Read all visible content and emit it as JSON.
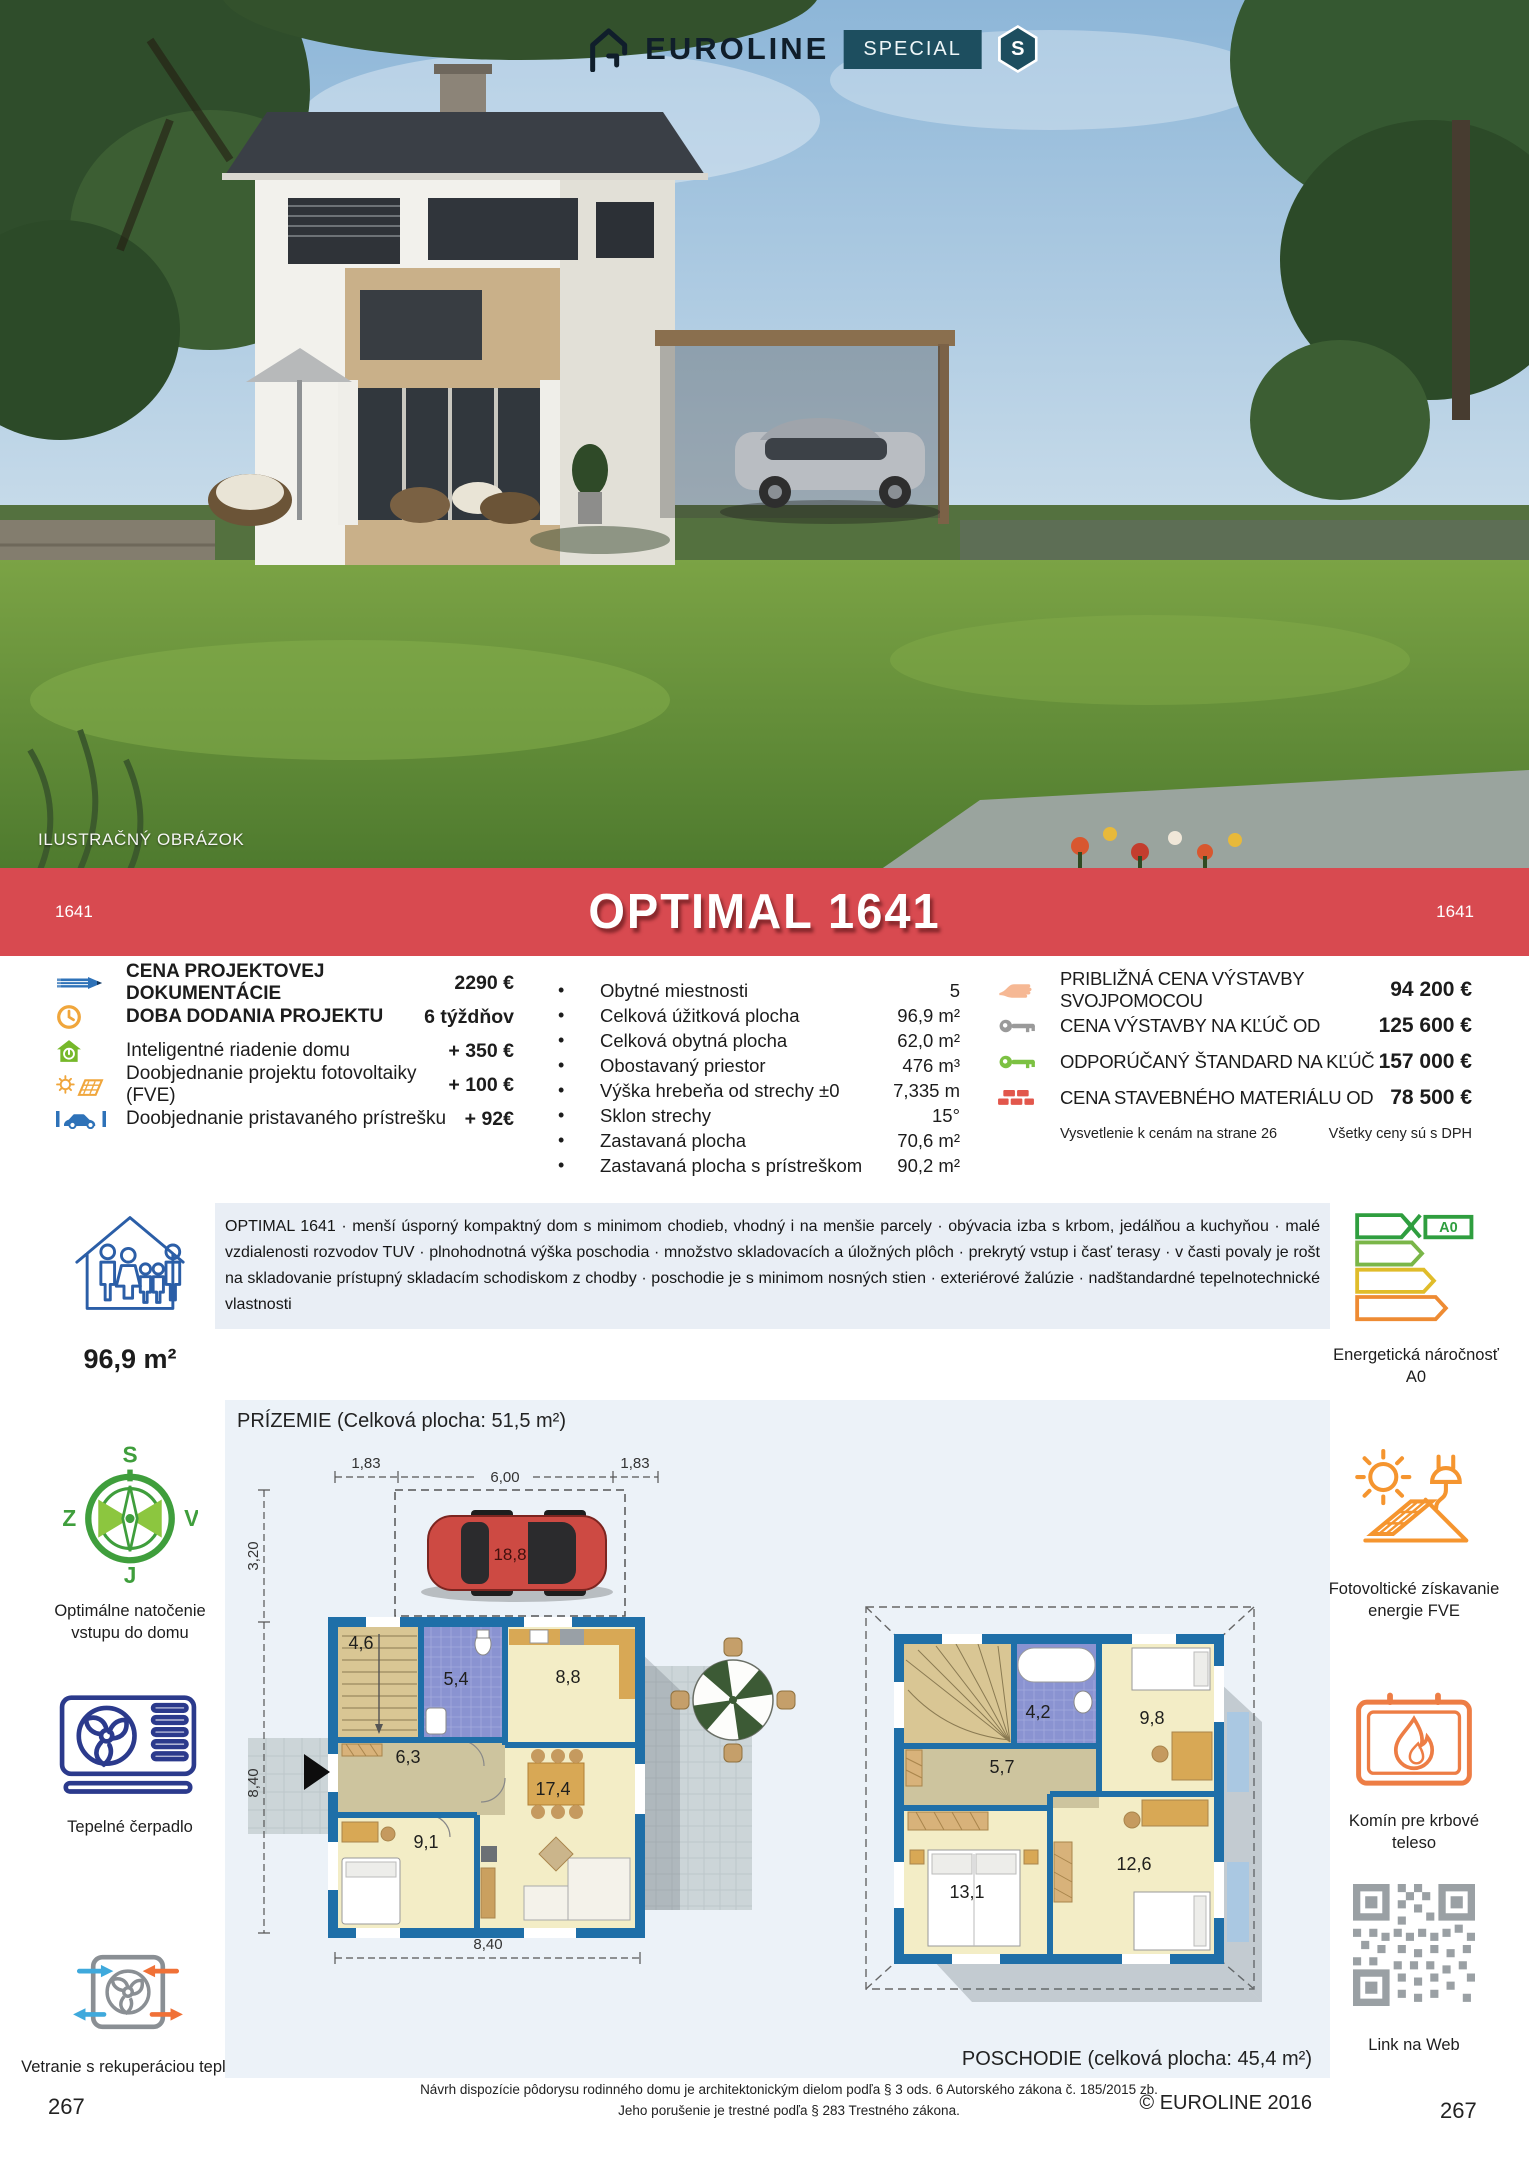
{
  "header": {
    "brand": "EUROLINE",
    "special_label": "SPECIAL",
    "badge_letter": "S",
    "photo_caption": "ILUSTRAČNÝ OBRÁZOK"
  },
  "banner": {
    "title": "OPTIMAL 1641",
    "code_left": "1641",
    "code_right": "1641",
    "color": "#d84a50"
  },
  "pricing_left": {
    "items": [
      {
        "icon": "pencil-icon",
        "label": "CENA PROJEKTOVEJ DOKUMENTÁCIE",
        "value": "2290 €"
      },
      {
        "icon": "clock-icon",
        "label": "DOBA DODANIA PROJEKTU",
        "value": "6 týždňov"
      },
      {
        "icon": "smart-home-icon",
        "label": "Inteligentné riadenie domu",
        "value": "+ 350 €"
      },
      {
        "icon": "solar-project-icon",
        "label": "Doobjednanie projektu fotovoltaiky (FVE)",
        "value": "+ 100 €"
      },
      {
        "icon": "carport-icon",
        "label": "Doobjednanie pristavaného prístrešku",
        "value": "+ 92€"
      }
    ]
  },
  "specs": {
    "items": [
      {
        "label": "Obytné miestnosti",
        "value": "5"
      },
      {
        "label": "Celková úžitková plocha",
        "value": "96,9 m²"
      },
      {
        "label": "Celková obytná plocha",
        "value": "62,0 m²"
      },
      {
        "label": "Obostavaný priestor",
        "value": "476 m³"
      },
      {
        "label": "Výška hrebeňa od strechy ±0",
        "value": "7,335 m"
      },
      {
        "label": "Sklon strechy",
        "value": "15°"
      },
      {
        "label": "Zastavaná plocha",
        "value": "70,6 m²"
      },
      {
        "label": "Zastavaná plocha s prístreškom",
        "value": "90,2 m²"
      }
    ]
  },
  "pricing_right": {
    "items": [
      {
        "icon": "hand-icon",
        "label": "PRIBLIŽNÁ CENA VÝSTAVBY SVOJPOMOCOU",
        "value": "94 200 €"
      },
      {
        "icon": "key-gray-icon",
        "label": "CENA VÝSTAVBY NA KĽÚČ OD",
        "value": "125 600 €"
      },
      {
        "icon": "key-green-icon",
        "label": "ODPORÚČANÝ ŠTANDARD NA KĽÚČ",
        "value": "157 000 €"
      },
      {
        "icon": "bricks-icon",
        "label": "CENA STAVEBNÉHO MATERIÁLU OD",
        "value": "78 500 €"
      }
    ],
    "note_left": "Vysvetlenie k cenám na strane 26",
    "note_right": "Všetky ceny sú s DPH"
  },
  "description": {
    "text": "OPTIMAL 1641 · menší úsporný kompaktný dom s minimom chodieb, vhodný i na menšie parcely · obývacia izba s krbom, jedálňou a kuchyňou · malé vzdialenosti rozvodov TUV · plnohodnotná výška poschodia · množstvo skladovacích a úložných plôch · prekrytý vstup i časť terasy · v časti povaly je rošt na skladovanie prístupný skladacím schodiskom z chodby · poschodie je s minimom nosných stien · exteriérové žalúzie · nadštandardné tepelnotechnické vlastnosti"
  },
  "sidebar_left": {
    "area": "96,9 m²",
    "compass": {
      "n": "S",
      "e": "V",
      "s": "J",
      "w": "Z",
      "caption": "Optimálne natočenie vstupu do domu"
    },
    "heatpump_caption": "Tepelné čerpadlo",
    "ventilation_caption": "Vetranie s rekuperáciou tepla",
    "page_number": "267"
  },
  "sidebar_right": {
    "energy": {
      "class_label": "A0",
      "caption": "Energetická náročnosť A0"
    },
    "fve_caption": "Fotovoltické získavanie energie FVE",
    "fireplace_caption": "Komín pre krbové teleso",
    "qr_caption": "Link na Web",
    "page_number": "267"
  },
  "floorplan": {
    "ground": {
      "title": "PRÍZEMIE (Celková plocha: 51,5 m²)",
      "dims": {
        "top_left": "1,83",
        "top_mid": "6,00",
        "top_right": "1,83",
        "left_top": "3,20",
        "left_bottom": "8,40",
        "bottom": "8,40"
      },
      "carport_area": "18,8",
      "rooms": {
        "stairs": "4,6",
        "bath": "5,4",
        "kitchen": "8,8",
        "hall": "6,3",
        "living": "17,4",
        "bedroom": "9,1"
      }
    },
    "upper": {
      "title": "POSCHODIE (celková plocha: 45,4 m²)",
      "rooms": {
        "bath": "4,2",
        "bedroom_right": "9,8",
        "hall": "5,7",
        "bedroom_left": "13,1",
        "bedroom_bottom": "12,6"
      }
    }
  },
  "footer": {
    "line1": "Návrh dispozície pôdorysu rodinného domu je architektonickým dielom podľa § 3 ods. 6 Autorského zákona č. 185/2015 zb.",
    "line2": "Jeho porušenie je trestné podľa § 283 Trestného zákona.",
    "copyright": "© EUROLINE 2016"
  }
}
